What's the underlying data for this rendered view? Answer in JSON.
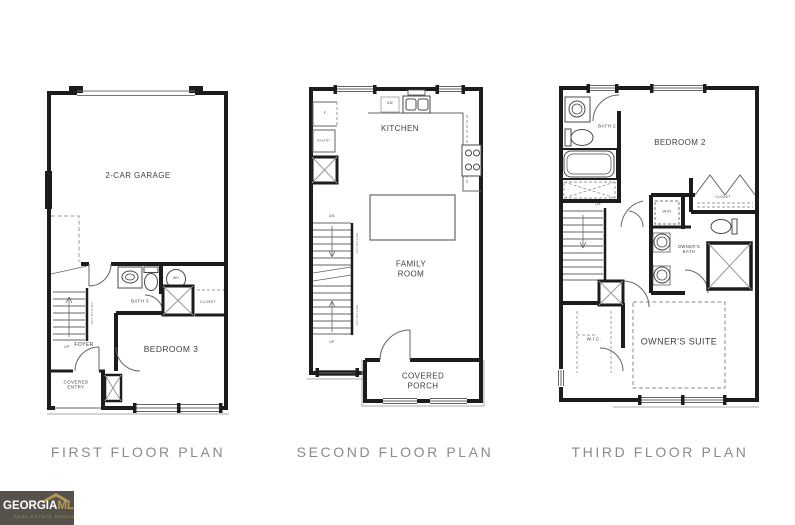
{
  "captions": {
    "first": "FIRST FLOOR PLAN",
    "second": "SECOND FLOOR PLAN",
    "third": "THIRD FLOOR PLAN"
  },
  "floor1": {
    "garage": "2-CAR GARAGE",
    "bath": "BATH 3",
    "wh": "WH",
    "closet": "CLOSET",
    "bedroom": "BEDROOM 3",
    "foyer": "FOYER",
    "covered_entry": "COVERED\nENTRY",
    "up": "UP",
    "opt_railing": "OPT RAILING"
  },
  "floor2": {
    "kitchen": "KITCHEN",
    "dw": "DW",
    "fridge": "F",
    "pantry": "PANTRY",
    "family_room": "FAMILY\nROOM",
    "covered_porch": "COVERED\nPORCH",
    "dn": "DN",
    "up": "UP",
    "opt_railing": "OPT RAILING"
  },
  "floor3": {
    "bath2": "BATH 2",
    "bedroom2": "BEDROOM 2",
    "dn": "DN",
    "wd": "W/D",
    "closet": "CLOSET",
    "owners_bath": "OWNER'S\nBATH",
    "wic": "W.I.C.",
    "owners_suite": "OWNER'S SUITE"
  },
  "logo": {
    "name": "GEORGIA",
    "suffix": "MLS",
    "tm": "™",
    "tagline": "REAL ESTATE SERVICES"
  },
  "colors": {
    "wall": "#1c1c1c",
    "fixture_line": "#4a4a4a",
    "thin_line": "#888888",
    "caption_text": "#8d8a86",
    "label_text": "#3f3f3f",
    "logo_background": "#56524b",
    "logo_gold": "#b59a55",
    "logo_white": "#ffffff"
  }
}
